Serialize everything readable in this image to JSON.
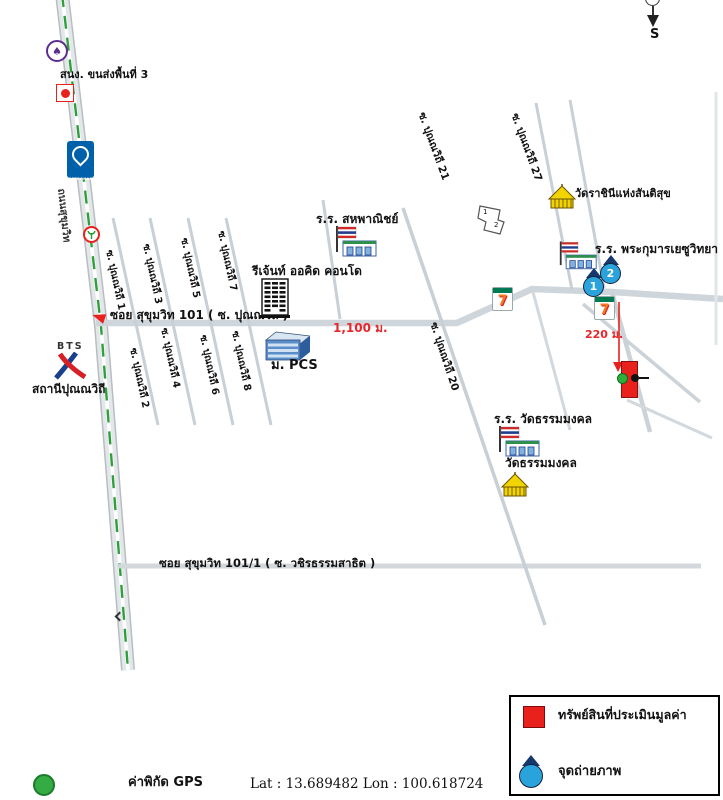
{
  "compass": {
    "south": "S"
  },
  "roads": {
    "main_road_label": "ถนนสุขุมวิท",
    "road_101_label": "ซอย สุขุมวิท 101 ( ซ. ปุณณวิถี )",
    "road_101_1_label": "ซอย สุขุมวิท 101/1 ( ซ. วชิรธรรมสาธิต )",
    "soi_1": "ซ. ปุณณวิถี 1",
    "soi_2": "ซ. ปุณณวิถี 2",
    "soi_3": "ซ. ปุณณวิถี 3",
    "soi_4": "ซ. ปุณณวิถี 4",
    "soi_5": "ซ. ปุณณวิถี 5",
    "soi_6": "ซ. ปุณณวิถี 6",
    "soi_7": "ซ. ปุณณวิถี 7",
    "soi_8": "ซ. ปุณณวิถี 8",
    "soi_20": "ซ. ปุณณวิถี 20",
    "soi_21": "ซ. ปุณณวิถี 21",
    "soi_27": "ซ. ปุณณวิถี 27"
  },
  "distances": {
    "along_road_101": "1,100 ม.",
    "to_property": "220 ม."
  },
  "places": {
    "transport_office": "สนง. ขนส่งพื้นที่ 3",
    "petronas_text": "PETRONAS",
    "school_sahapanich": "ร.ร. สหพาณิชย์",
    "condo_regent_orchid": "รีเจ้นท์ ออคิด คอนโด",
    "pcs": "ม. PCS",
    "bts_logo_text": "BTS",
    "bts_station": "สถานีปุณณวิถี",
    "temple_queen_of_peace": "วัดราชินีแห่งสันติสุข",
    "school_holy_infant_jesus": "ร.ร. พระกุมารเยซูวิทยา",
    "school_wat_dhammamongkol": "ร.ร. วัดธรรมมงคล",
    "temple_wat_dhammamongkol": "วัดธรรมมงคล",
    "seven_eleven_glyph": "7"
  },
  "markers": {
    "photo_point_1": "1",
    "photo_point_2": "2",
    "plot_no_1": "1",
    "plot_no_2": "2"
  },
  "legend": {
    "property_label": "ทรัพย์สินที่ประเมินมูลค่า",
    "photo_point_label": "จุดถ่ายภาพ"
  },
  "gps": {
    "label": "ค่าพิกัด GPS",
    "coordinates": "Lat : 13.689482 Lon : 100.618724"
  },
  "colors": {
    "property_red": "#e8211d",
    "photo_marker_blue": "#2aa3dd",
    "temple_yellow": "#f2d500",
    "gps_green": "#35ab43",
    "road_dash_green": "#2f9e3c",
    "distance_red": "#e8262a"
  }
}
